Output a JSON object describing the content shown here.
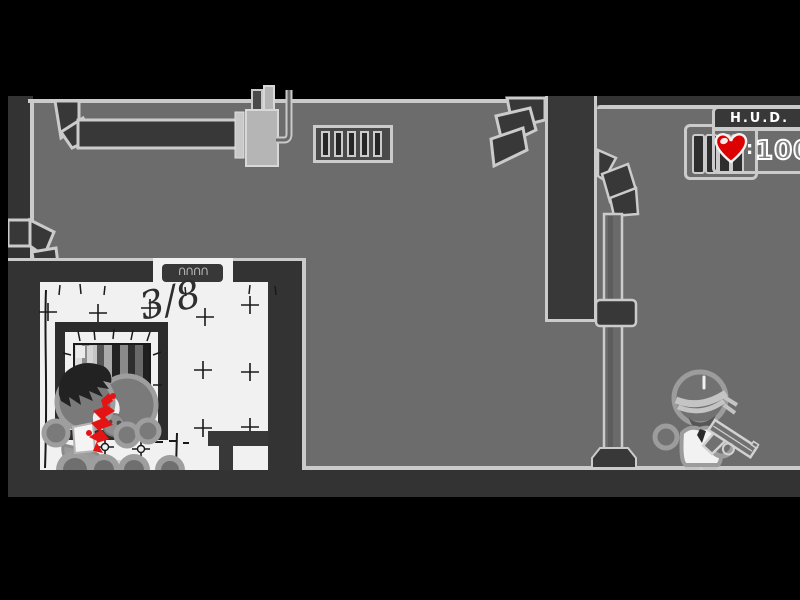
{
  "hud": {
    "title": "H.U.D.",
    "separator": ":",
    "health": "100",
    "heart_icon": "heart-icon",
    "ammo_slot_count": 4
  },
  "wall_markings": {
    "fraction": "3/8",
    "door_sign_squiggles": "∩∩∩∩"
  },
  "scene": {
    "wall_vent_slat_count": 5,
    "body_pile_head_count": 3,
    "floor_mound_count": 4
  },
  "colors": {
    "letterbox_black": "#000000",
    "wall_gray": "#6c6c6c",
    "dark_structure": "#383838",
    "outer_dark": "#333333",
    "outline_light": "#cbcbcb",
    "white_room": "#f1f1f1",
    "blood_red": "#e41414",
    "heart_red": "#dd0000",
    "hud_text": "#ffffff",
    "sketch_ink": "#1a1a1a"
  }
}
